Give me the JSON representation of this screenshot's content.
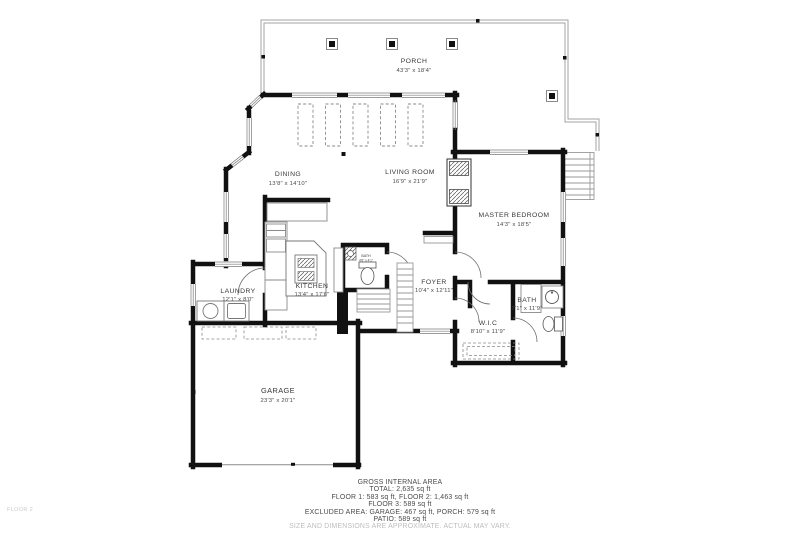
{
  "page": {
    "floor_label": "FLOOR 2"
  },
  "colors": {
    "wall": "#111111",
    "thin_line": "#999999",
    "label_text": "#3a3a3a",
    "muted_text": "#bdbdbd"
  },
  "rooms": {
    "porch": {
      "name": "PORCH",
      "dims": "43'3\" x 18'4\""
    },
    "dining": {
      "name": "DINING",
      "dims": "13'8\" x 14'10\""
    },
    "living_room": {
      "name": "LIVING ROOM",
      "dims": "16'9\" x 21'9\""
    },
    "master_bedroom": {
      "name": "MASTER BEDROOM",
      "dims": "14'3\" x 18'5\""
    },
    "laundry": {
      "name": "LAUNDRY",
      "dims": "12'1\" x 8'0\""
    },
    "kitchen": {
      "name": "KITCHEN",
      "dims": "13'4\" x 17'6\""
    },
    "foyer": {
      "name": "FOYER",
      "dims": "10'4\" x 12'11\""
    },
    "powder_bath": {
      "name": "BATH",
      "dims": "4'6\" x 4'1\""
    },
    "bath": {
      "name": "BATH",
      "dims": "7'1\" x 11'9\""
    },
    "wic": {
      "name": "W.I.C",
      "dims": "8'10\" x 11'9\""
    },
    "garage": {
      "name": "GARAGE",
      "dims": "23'3\" x 20'1\""
    }
  },
  "footer": {
    "title": "GROSS INTERNAL AREA",
    "lines": [
      "TOTAL: 2,635 sq ft",
      "FLOOR 1: 583 sq ft, FLOOR 2: 1,463 sq ft",
      "FLOOR 3: 589 sq ft",
      "EXCLUDED AREA: GARAGE: 467 sq ft, PORCH: 579 sq ft",
      "PATIO: 589 sq ft"
    ],
    "disclaimer": "SIZE AND DIMENSIONS ARE APPROXIMATE. ACTUAL MAY VARY."
  }
}
